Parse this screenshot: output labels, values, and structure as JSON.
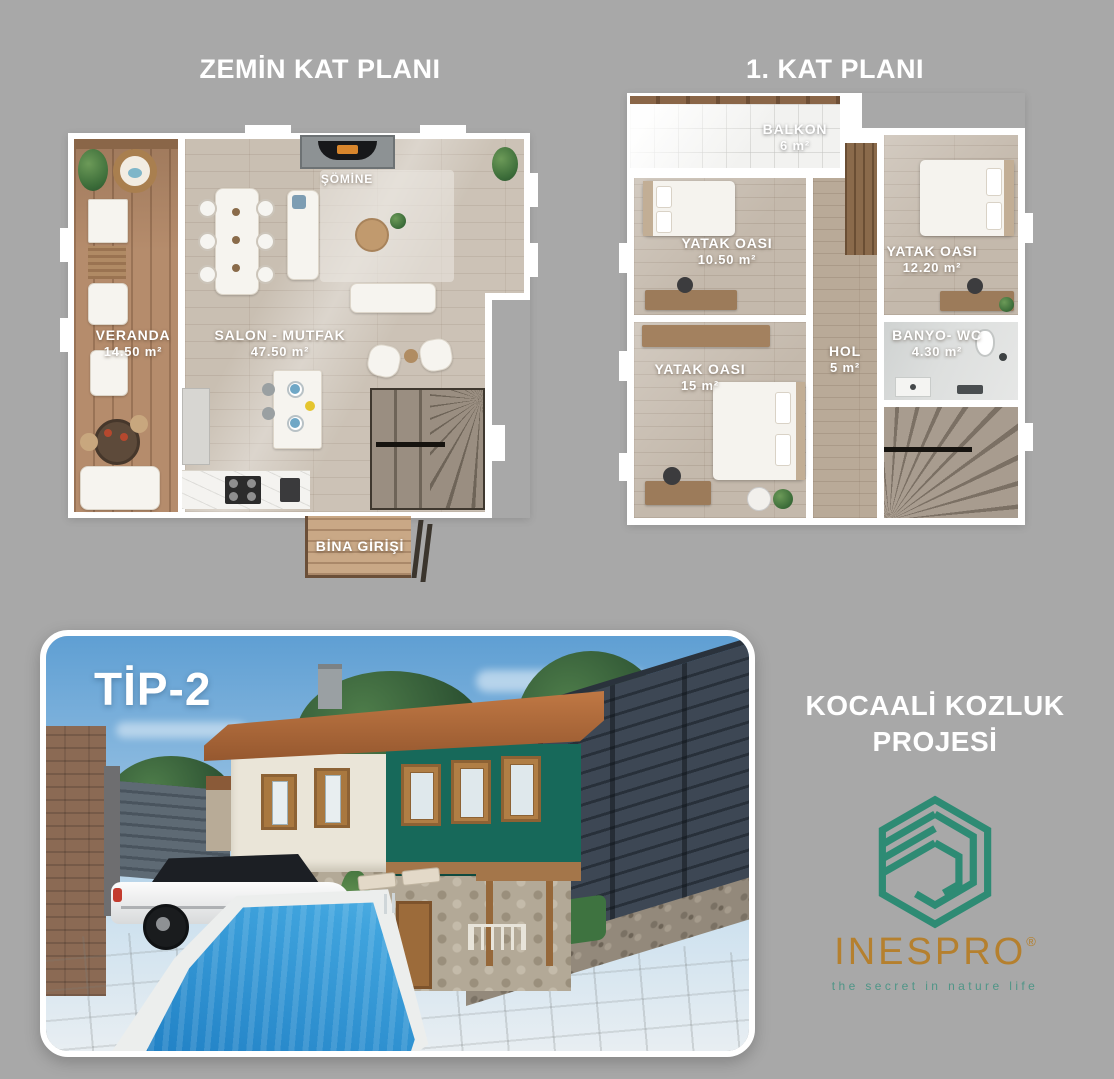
{
  "meta": {
    "background_color": "#a8a8a8"
  },
  "ground_floor": {
    "title": "ZEMİN KAT PLANI",
    "veranda_name": "VERANDA",
    "veranda_area": "14.50 m²",
    "salon_name": "SALON - MUTFAK",
    "salon_area": "47.50 m²",
    "fireplace": "ŞÖMİNE",
    "entrance": "BİNA GİRİŞİ"
  },
  "first_floor": {
    "title": "1. KAT PLANI",
    "balcony_name": "BALKON",
    "balcony_area": "6 m²",
    "bedroom1_name": "YATAK OASI",
    "bedroom1_area": "10.50 m²",
    "bedroom2_name": "YATAK OASI",
    "bedroom2_area": "12.20 m²",
    "bedroom3_name": "YATAK OASI",
    "bedroom3_area": "15 m²",
    "hall_name": "HOL",
    "hall_area": "5 m²",
    "bath_name": "BANYO- WC",
    "bath_area": "4.30 m²"
  },
  "render": {
    "type_label": "TİP-2",
    "pool_color": "#2e8ed2",
    "fence_color": "#3d4754"
  },
  "brand": {
    "project_title_line1": "KOCAALİ KOZLUK",
    "project_title_line2": "PROJESİ",
    "logo_name": "INESPRO",
    "registered": "®",
    "tagline": "the secret in nature life",
    "logo_color": "#2e8b74",
    "logo_text_color": "#b5802e",
    "tagline_color": "#4f9587"
  }
}
